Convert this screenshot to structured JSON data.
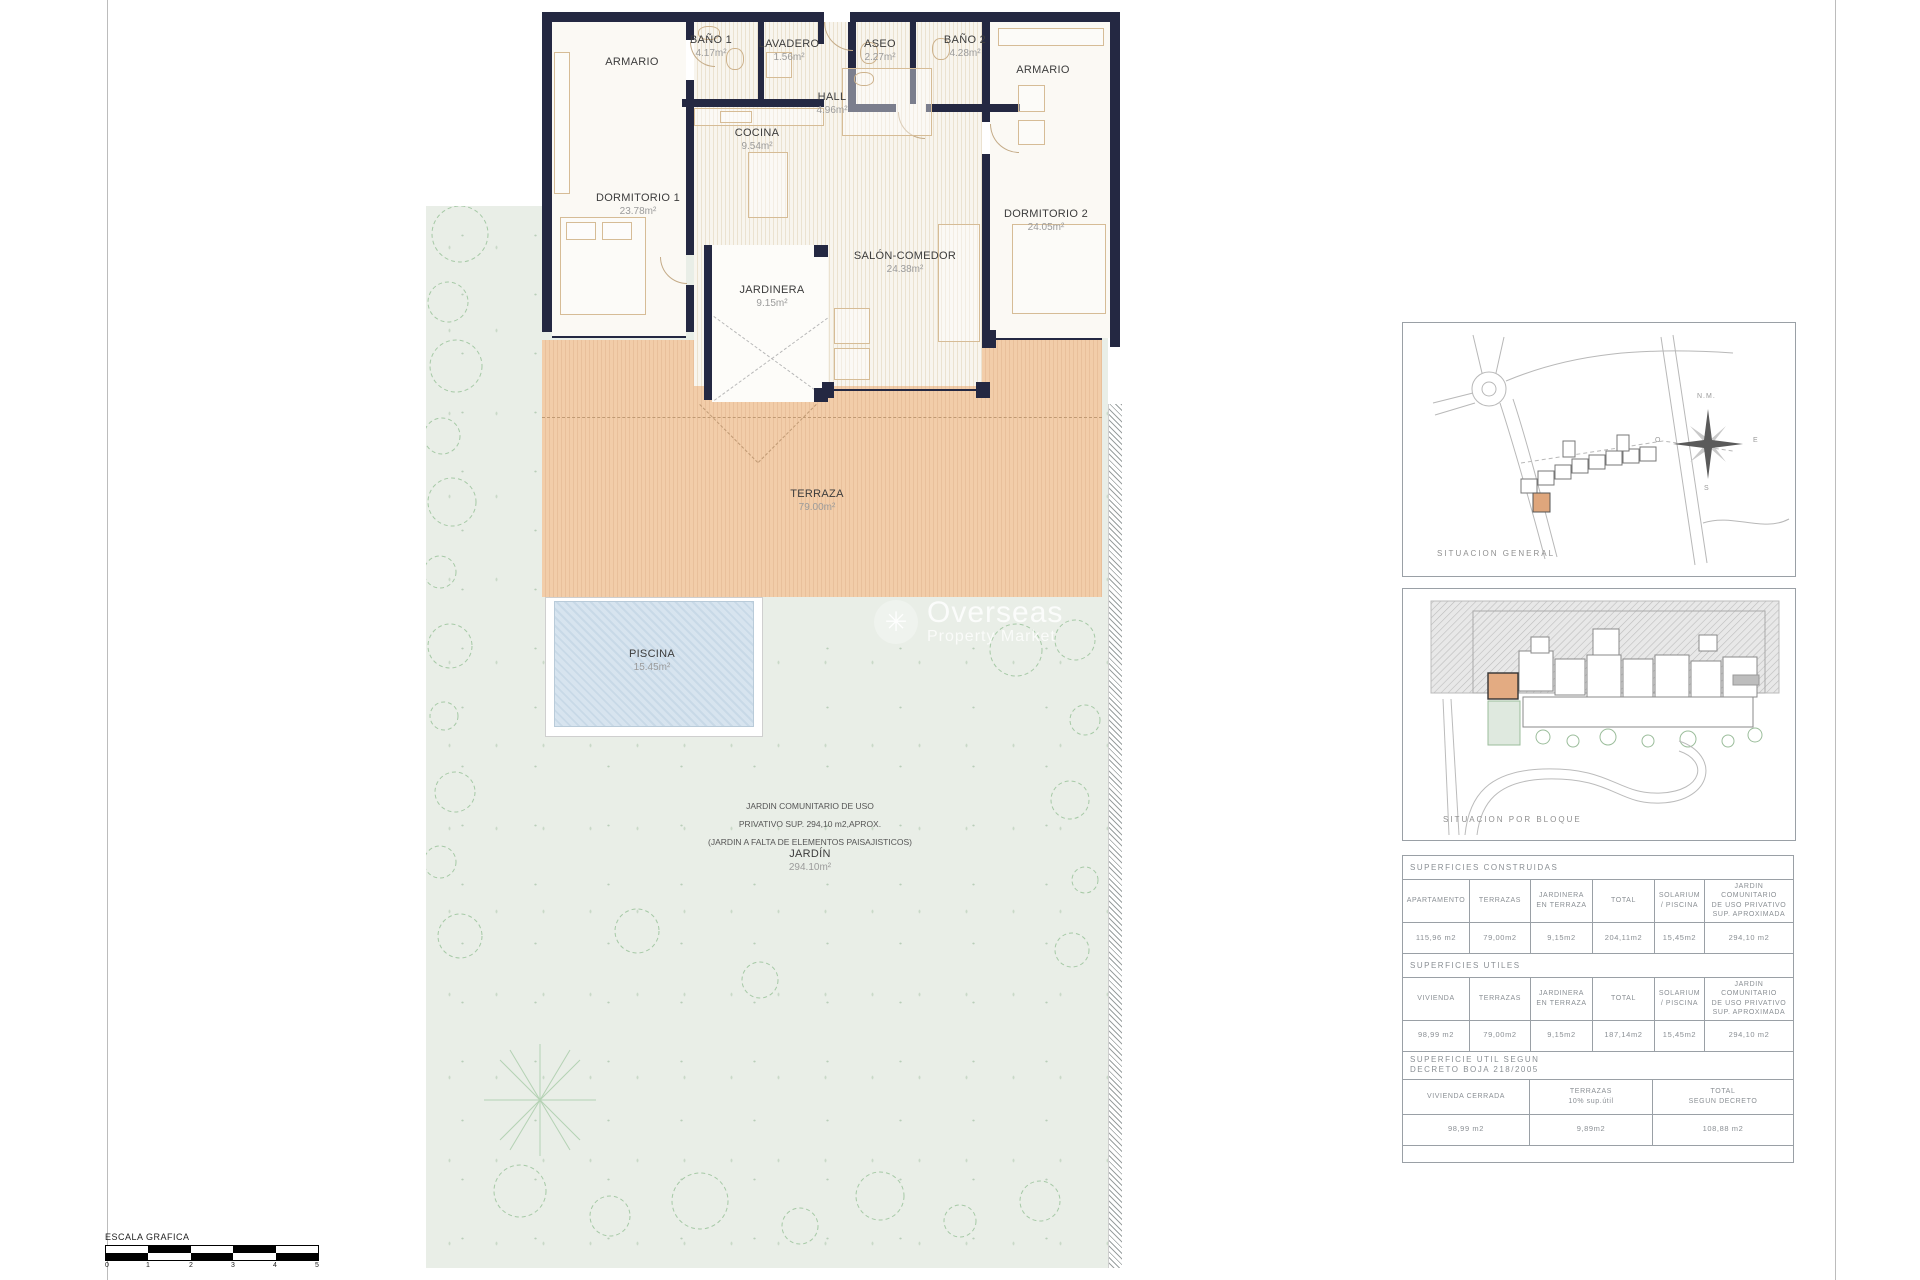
{
  "plan": {
    "rooms": {
      "armario_1": {
        "name": "ARMARIO",
        "area": ""
      },
      "bano1": {
        "name": "BAÑO 1",
        "area": "4.17m²"
      },
      "lavadero": {
        "name": "LAVADERO",
        "area": "1.56m²"
      },
      "aseo": {
        "name": "ASEO",
        "area": "2.27m²"
      },
      "bano2": {
        "name": "BAÑO 2",
        "area": "4.28m²"
      },
      "armario_2": {
        "name": "ARMARIO",
        "area": ""
      },
      "hall": {
        "name": "HALL",
        "area": "4.96m²"
      },
      "cocina": {
        "name": "COCINA",
        "area": "9.54m²"
      },
      "dormitorio1": {
        "name": "DORMITORIO 1",
        "area": "23.78m²"
      },
      "salon": {
        "name": "SALÓN-COMEDOR",
        "area": "24.38m²"
      },
      "dormitorio2": {
        "name": "DORMITORIO 2",
        "area": "24.05m²"
      },
      "jardinera": {
        "name": "JARDINERA",
        "area": "9.15m²"
      },
      "terraza": {
        "name": "TERRAZA",
        "area": "79.00m²"
      },
      "piscina": {
        "name": "PISCINA",
        "area": "15.45m²"
      },
      "jardin": {
        "name": "JARDÍN",
        "area": "294.10m²"
      }
    },
    "garden_note": "JARDIN COMUNITARIO  DE USO\nPRIVATIVO SUP. 294,10  m2,APROX.\n(JARDIN A FALTA DE  ELEMENTOS PAISAJISTICOS)"
  },
  "watermark": {
    "brand": "Overseas",
    "tagline": "Property Market"
  },
  "situation_general": {
    "caption": "SITUACION   GENERAL",
    "compass": {
      "north": "N.M.",
      "east": "E",
      "south": "S",
      "west": "O"
    }
  },
  "situation_bloque": {
    "caption": "SITUACION   POR   BLOQUE"
  },
  "tables": {
    "constructed": {
      "title": "SUPERFICIES   CONSTRUIDAS",
      "headers": [
        "APARTAMENTO",
        "TERRAZAS",
        "JARDINERA\nEN  TERRAZA",
        "TOTAL",
        "SOLARIUM\n/  PISCINA",
        "JARDIN  COMUNITARIO\nDE  USO    PRIVATIVO\nSUP.  APROXIMADA"
      ],
      "values": [
        "115,96  m2",
        "79,00m2",
        "9,15m2",
        "204,11m2",
        "15,45m2",
        "294,10  m2"
      ]
    },
    "useful": {
      "title": "SUPERFICIES   UTILES",
      "headers": [
        "VIVIENDA",
        "TERRAZAS",
        "JARDINERA\nEN  TERRAZA",
        "TOTAL",
        "SOLARIUM\n/  PISCINA",
        "JARDIN  COMUNITARIO\nDE  USO    PRIVATIVO\nSUP.  APROXIMADA"
      ],
      "values": [
        "98,99  m2",
        "79,00m2",
        "9,15m2",
        "187,14m2",
        "15,45m2",
        "294,10  m2"
      ]
    },
    "decree": {
      "title": "SUPERFICIE  UTIL  SEGUN\nDECRETO  BOJA  218/2005",
      "headers": [
        "VIVIENDA  CERRADA",
        "TERRAZAS\n10%  sup.útil",
        "TOTAL\nSEGUN  DECRETO"
      ],
      "values": [
        "98,99  m2",
        "9,89m2",
        "108,88  m2"
      ]
    }
  },
  "scale_bar": {
    "label": "ESCALA GRAFICA",
    "ticks": [
      "0",
      "1",
      "2",
      "3",
      "4",
      "5"
    ]
  }
}
